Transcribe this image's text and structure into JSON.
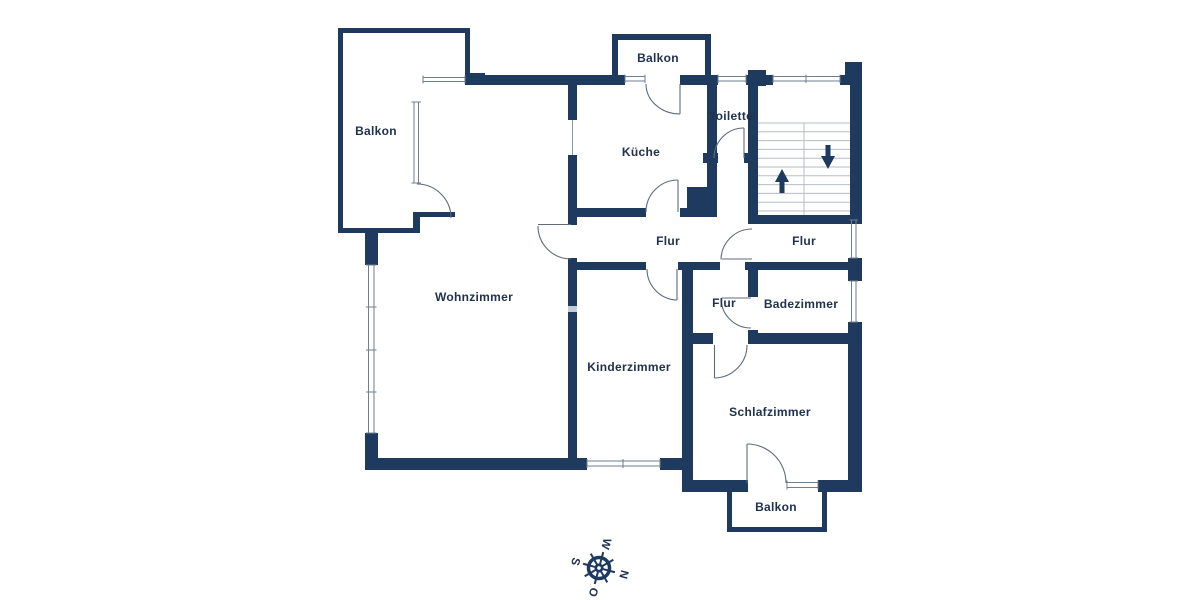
{
  "plan_title": "Grundriss Wohnung (floor plan)",
  "rooms": {
    "balkon_top_left": "Balkon",
    "balkon_top": "Balkon",
    "kueche": "Küche",
    "toilette": "Toilette",
    "flur_main": "Flur",
    "flur_stairwell": "Flur",
    "flur_small": "Flur",
    "badezimmer": "Badezimmer",
    "wohnzimmer": "Wohnzimmer",
    "kinderzimmer": "Kinderzimmer",
    "schlafzimmer": "Schlafzimmer",
    "balkon_bottom": "Balkon"
  },
  "compass": {
    "north": "N",
    "east": "O",
    "south": "S",
    "west": "W"
  },
  "icons": {
    "stairs_up": "stairs-up-arrow-icon",
    "stairs_down": "stairs-down-arrow-icon",
    "compass": "compass-rose-icon"
  },
  "colors": {
    "wall": "#1e3a5f",
    "label_text": "#20324e",
    "step_line": "#b6bdc5",
    "window_line": "#6e7f91",
    "door_arc": "#5f6b78",
    "background": "#ffffff"
  }
}
